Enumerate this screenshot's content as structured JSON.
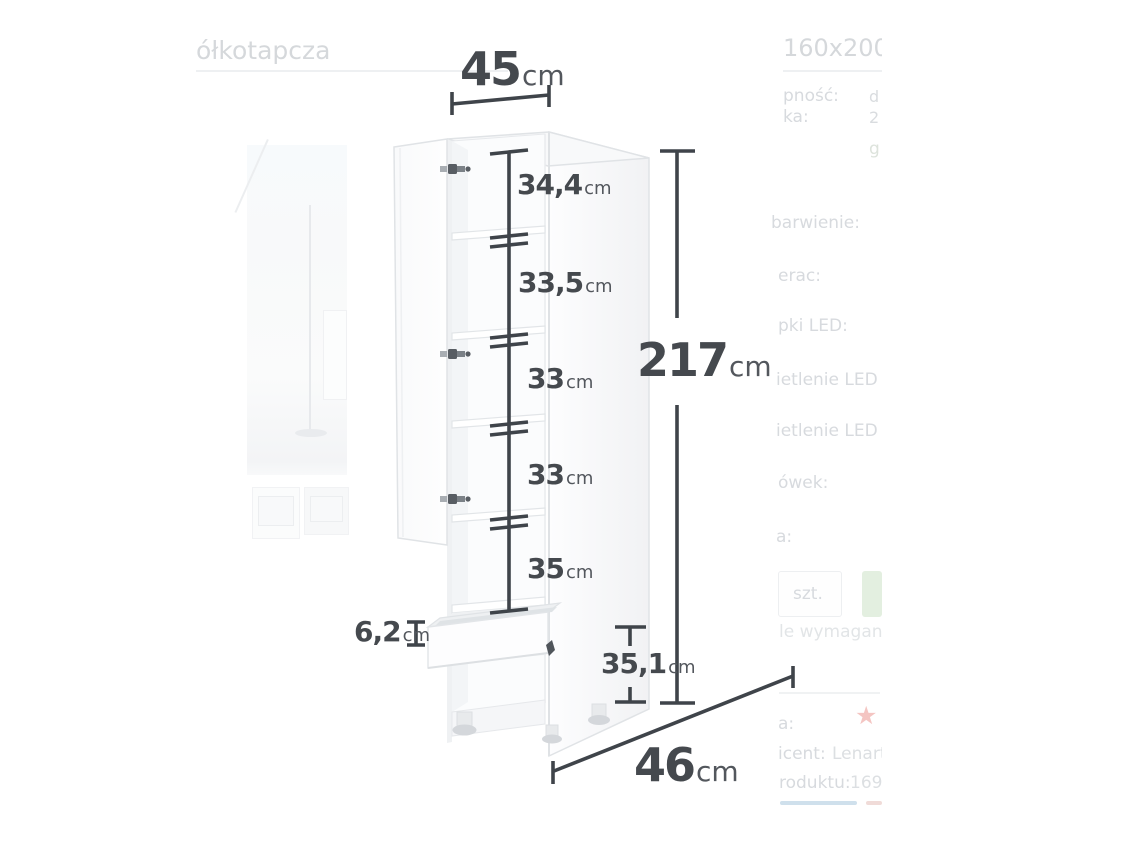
{
  "diagram": {
    "width_label": {
      "num": "45",
      "unit": "cm"
    },
    "height_label": {
      "num": "217",
      "unit": "cm"
    },
    "depth_label": {
      "num": "46",
      "unit": "cm"
    },
    "drawer_label": {
      "num": "6,2",
      "unit": "cm"
    },
    "bottom_label": {
      "num": "35,1",
      "unit": "cm"
    },
    "shelves": [
      {
        "num": "34,4",
        "unit": "cm"
      },
      {
        "num": "33,5",
        "unit": "cm"
      },
      {
        "num": "33",
        "unit": "cm"
      },
      {
        "num": "33",
        "unit": "cm"
      },
      {
        "num": "35",
        "unit": "cm"
      }
    ]
  },
  "background_page": {
    "left_title_fragment": "ółkotapcza",
    "right_title_fragment": "160x200 c",
    "spec_rows": [
      {
        "label": "pność:",
        "value": "d"
      },
      {
        "label": "ka:",
        "value": "2"
      }
    ],
    "link_fragment": "g",
    "option_labels": [
      "barwienie:",
      "erac:",
      "pki LED:",
      "ietlenie LED p",
      "ietlenie LED b",
      "ówek:",
      "a:"
    ],
    "qty_unit": "szt.",
    "required_note": "le wymagane",
    "price_label_fragment": "a:",
    "star_icon_glyph": "★",
    "producer": {
      "label": "icent:",
      "value": "Lenart"
    },
    "product_code": {
      "label": "roduktu:",
      "value": "1695"
    }
  },
  "colors": {
    "dimension_text": "#45494e",
    "dimension_line": "#3f444a",
    "faded_text": "#d7dade",
    "accent_green": "#e3efe0",
    "star_red": "#f4c5c2",
    "tab_blue": "#cfe0ec",
    "tab_pink": "#f0dbd8"
  }
}
